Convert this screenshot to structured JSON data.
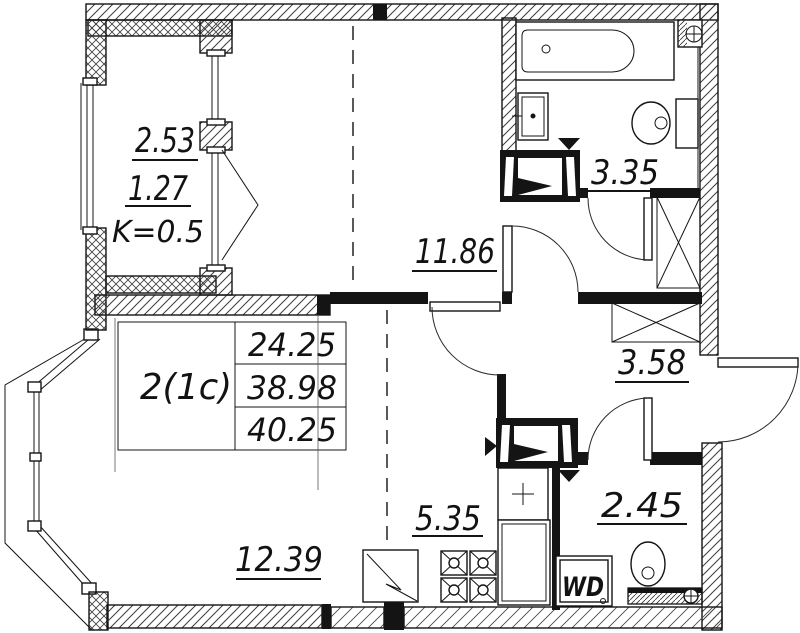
{
  "plan": {
    "title": "apartment-floor-plan",
    "table": {
      "type": "2(1c)",
      "living_area": "24.25",
      "apartment_area": "38.98",
      "total_area": "40.25"
    },
    "balcony": {
      "area_full": "2.53",
      "area_reduced": "1.27",
      "coefficient": "K=0.5"
    },
    "rooms": {
      "bedroom": "11.86",
      "bathroom": "3.35",
      "hallway": "3.58",
      "kitchen_zone": "5.35",
      "living_zone": "12.39",
      "wc": "2.45"
    },
    "appliances": {
      "washer_dryer": "WD"
    },
    "colors": {
      "line": "#141414",
      "background": "#ffffff"
    }
  }
}
